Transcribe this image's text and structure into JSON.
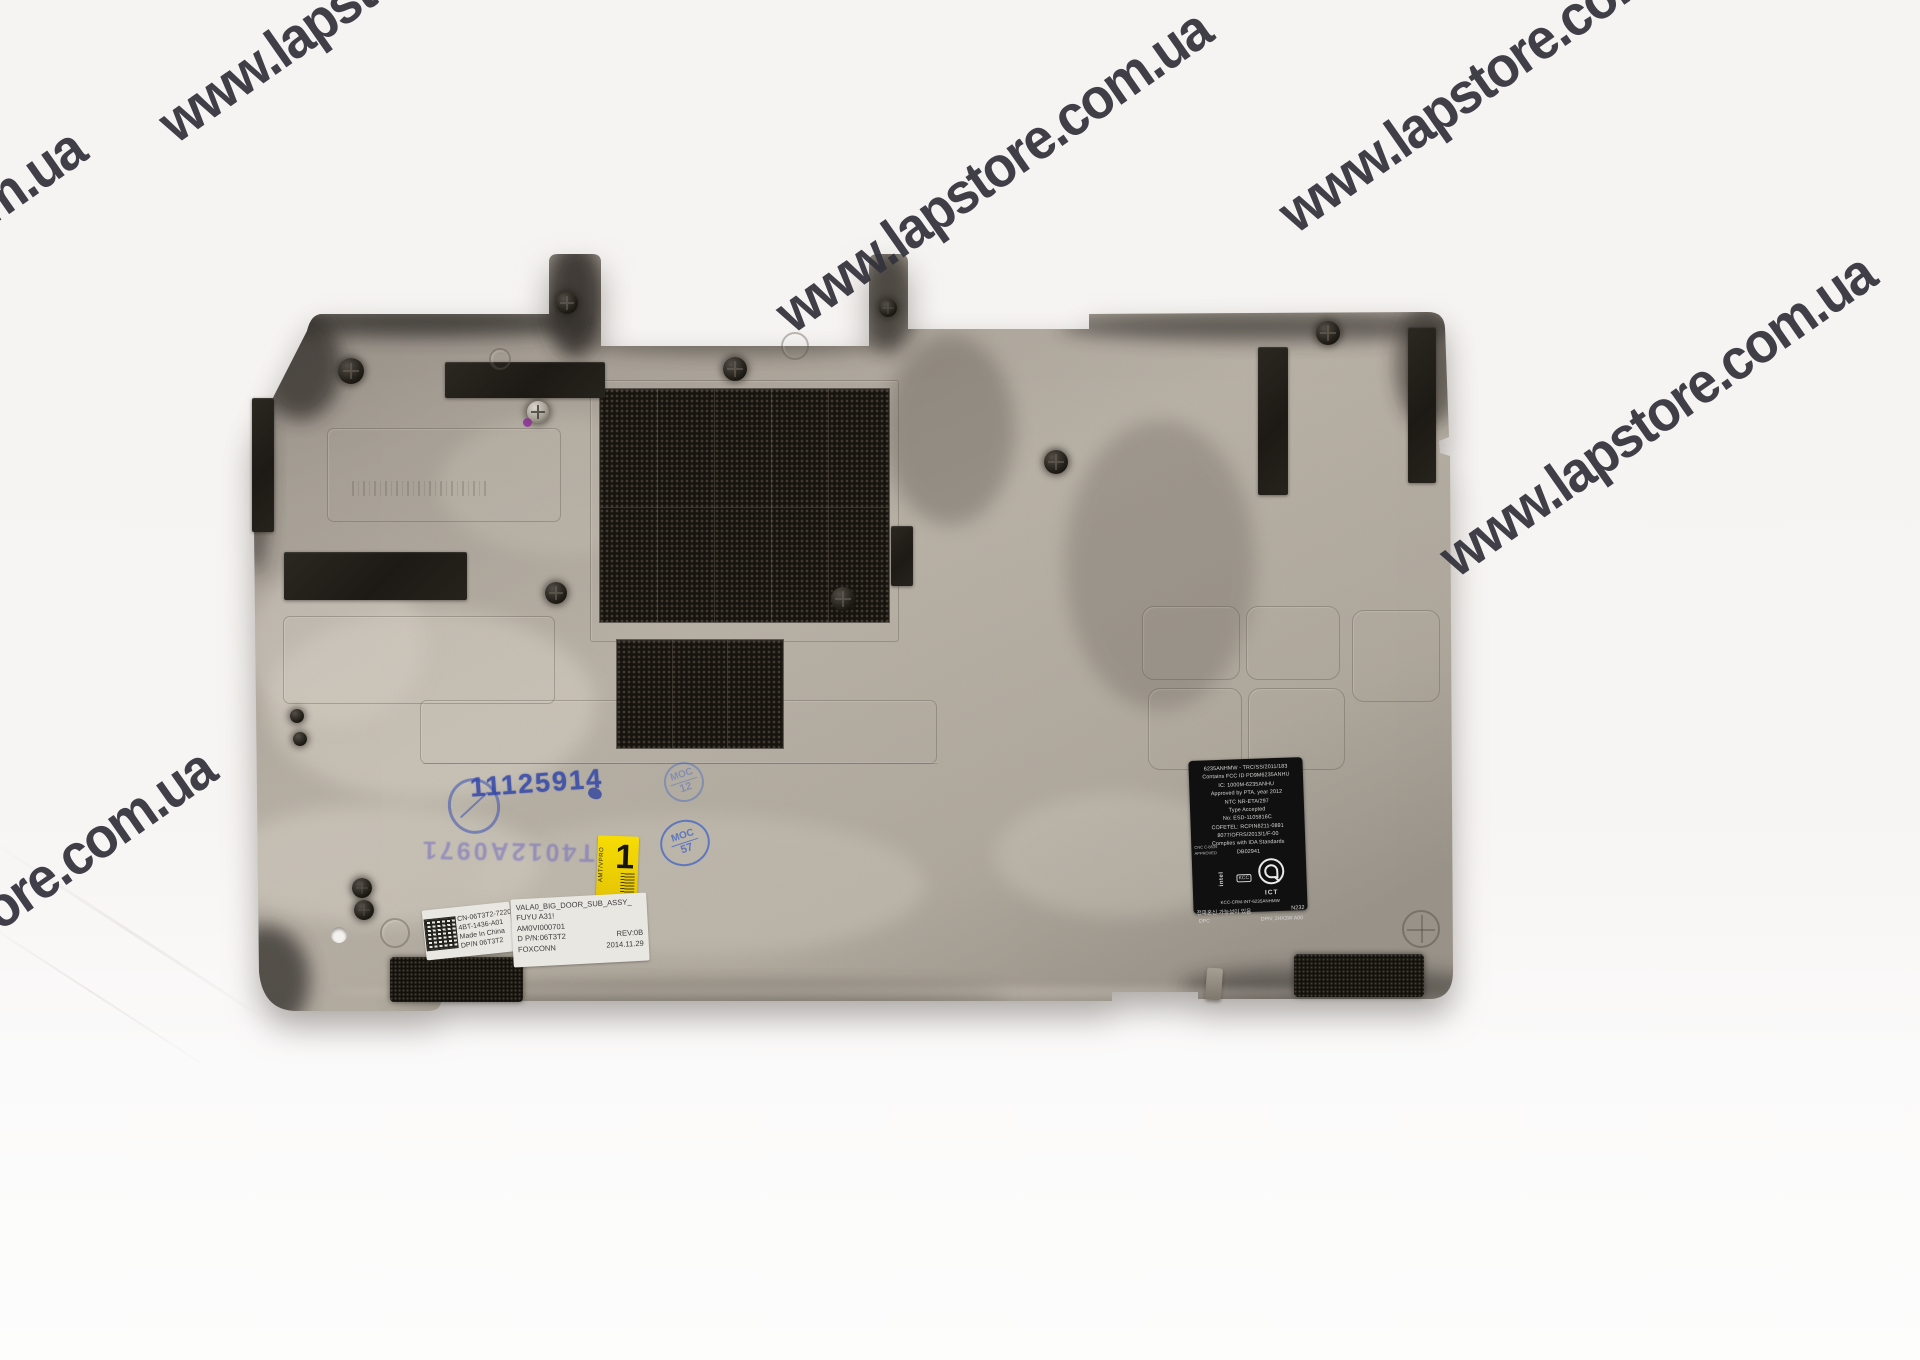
{
  "watermark": {
    "text": "www.lapstore.com.ua"
  },
  "stamps": {
    "serial": "11125914",
    "serial_inverted": "T4012A0971",
    "moc_top": {
      "label": "MOC",
      "number": "12"
    },
    "moc_bottom": {
      "label": "MOC",
      "number": "57"
    }
  },
  "labels": {
    "yellow": {
      "big": "1",
      "side": "AMT/VPRO"
    },
    "white_left": {
      "lines": [
        "CN-06T3T2-72206-",
        "4BT-1436-A01",
        "Made In China",
        "DP/N 06T3T2"
      ]
    },
    "white_right": {
      "lines": [
        "VALA0_BIG_DOOR_SUB_ASSY_",
        "FUYU A31!",
        "AM0VI000701",
        "D P/N:06T3T2",
        "REV:0B",
        "FOXCONN",
        "2014.11.29"
      ]
    },
    "regulatory": {
      "lines": [
        "6235ANHMW - TRC/SS/2011/183",
        "Contains FCC ID PD9M6235ANHU",
        "IC: 1000M-6235ANHU",
        "Approved by PTA, year 2012",
        "NTC      NR-ETA/297",
        "Type Accepted",
        "No: ESD-1105816C",
        "COFETEL: RCPIN6211-0891",
        "8077/OFRS/2013/1/F-00",
        "Complies with IDA Standards",
        "DB02941"
      ],
      "micro1": "CNC C-8639",
      "micro2": "APPROVED",
      "intel": "intel",
      "kcc": "KCC",
      "ict": "ICT",
      "kcc_id": "KCC-CRM-INT-6235ANHMW",
      "korean": "전파혼신 가능성이 있음",
      "n232": "N232",
      "dpc": "DPC",
      "dpn": "DPN: 2HX3W A00"
    }
  },
  "colors": {
    "panel_base": "#b3aca1",
    "watermark": "#33323c",
    "stamp_blue": "#3347a8",
    "sticker_yellow": "#f0d400"
  }
}
